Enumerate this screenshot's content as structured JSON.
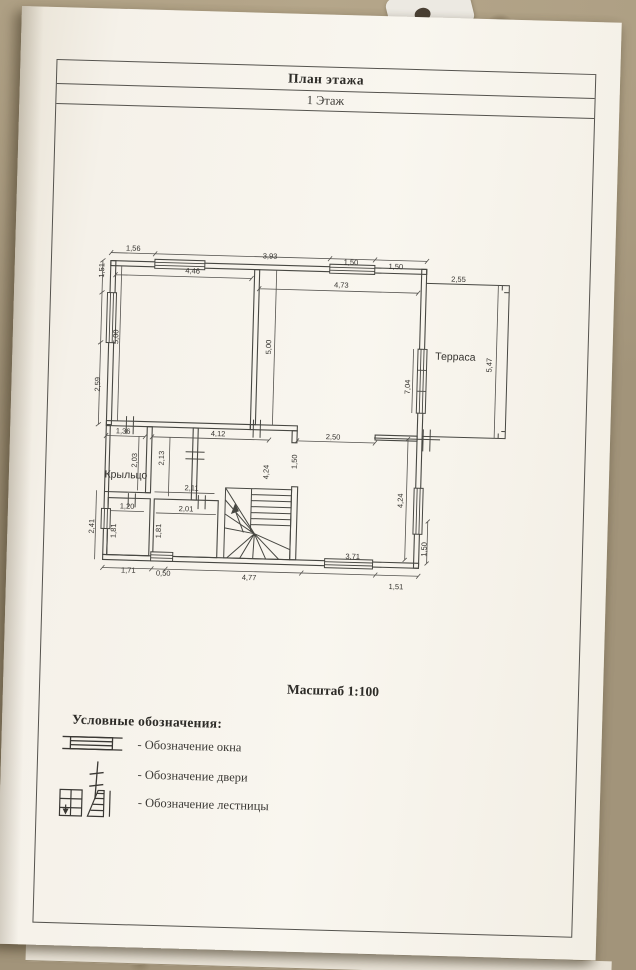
{
  "title_block": {
    "title": "План этажа",
    "subtitle": "1 Этаж"
  },
  "scale_label": "Масштаб 1:100",
  "legend": {
    "heading": "Условные обозначения:",
    "items": [
      {
        "icon": "window-symbol-icon",
        "label": "- Обозначение окна"
      },
      {
        "icon": "door-symbol-icon",
        "label": "- Обозначение двери"
      },
      {
        "icon": "stairs-symbol-icon",
        "label": "- Обозначение лестницы"
      }
    ]
  },
  "plan": {
    "rooms": [
      {
        "name": "Терраса",
        "x": 363,
        "y": 103
      },
      {
        "name": "Крыльцо",
        "x": 37,
        "y": 230
      }
    ],
    "dimensions": [
      {
        "t": "1,56",
        "x": 38,
        "y": 3
      },
      {
        "t": "3,93",
        "x": 175,
        "y": 7
      },
      {
        "t": "1,50",
        "x": 256,
        "y": 11
      },
      {
        "t": "1,50",
        "x": 301,
        "y": 14
      },
      {
        "t": "4,46",
        "x": 98,
        "y": 24
      },
      {
        "t": "4,73",
        "x": 247,
        "y": 34
      },
      {
        "t": "2,55",
        "x": 364,
        "y": 25
      },
      {
        "t": "1,51",
        "x": 7,
        "y": 26,
        "r": 1
      },
      {
        "t": "5,00",
        "x": 23,
        "y": 92,
        "r": 1
      },
      {
        "t": "2,59",
        "x": 6,
        "y": 140,
        "r": 1
      },
      {
        "t": "5,00",
        "x": 176,
        "y": 98,
        "r": 1
      },
      {
        "t": "5,47",
        "x": 397,
        "y": 110,
        "r": 1
      },
      {
        "t": "7,04",
        "x": 316,
        "y": 134,
        "r": 1
      },
      {
        "t": "1,36",
        "x": 33,
        "y": 186
      },
      {
        "t": "4,12",
        "x": 128,
        "y": 186
      },
      {
        "t": "2,50",
        "x": 243,
        "y": 186
      },
      {
        "t": "2,03",
        "x": 45,
        "y": 215,
        "r": 1
      },
      {
        "t": "2,13",
        "x": 72,
        "y": 212,
        "r": 1
      },
      {
        "t": "1,50",
        "x": 205,
        "y": 212,
        "r": 1
      },
      {
        "t": "4,24",
        "x": 177,
        "y": 223,
        "r": 1
      },
      {
        "t": "2,11",
        "x": 103,
        "y": 241
      },
      {
        "t": "1,20",
        "x": 39,
        "y": 261
      },
      {
        "t": "2,01",
        "x": 98,
        "y": 262
      },
      {
        "t": "1,81",
        "x": 26,
        "y": 286,
        "r": 1
      },
      {
        "t": "1,81",
        "x": 71,
        "y": 285,
        "r": 1
      },
      {
        "t": "2,41",
        "x": 4,
        "y": 282,
        "r": 1
      },
      {
        "t": "4,24",
        "x": 312,
        "y": 248,
        "r": 1
      },
      {
        "t": "1,50",
        "x": 337,
        "y": 296,
        "r": 1
      },
      {
        "t": "3,71",
        "x": 266,
        "y": 305
      },
      {
        "t": "1,71",
        "x": 42,
        "y": 325
      },
      {
        "t": "0,50",
        "x": 77,
        "y": 327
      },
      {
        "t": "4,77",
        "x": 163,
        "y": 329
      },
      {
        "t": "1,51",
        "x": 310,
        "y": 334
      }
    ]
  }
}
